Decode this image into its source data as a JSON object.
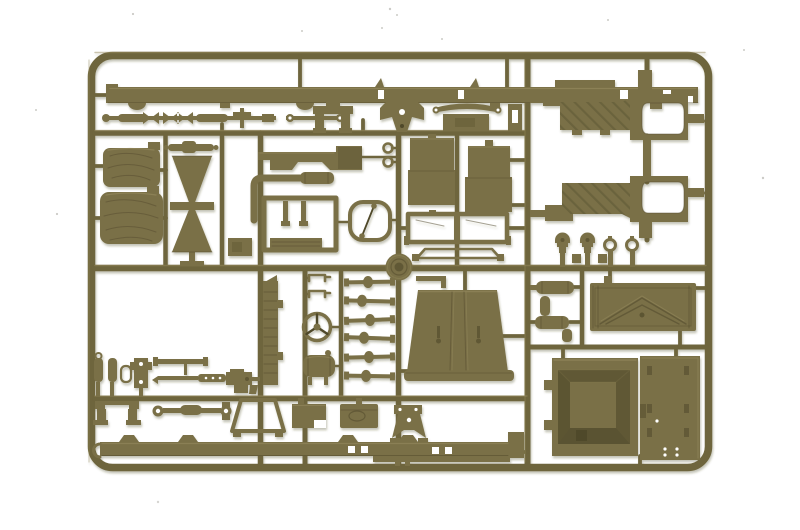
{
  "scene": {
    "description": "Photograph of an olive drab injection-molded plastic model kit sprue (parts tree) of military vehicle components on a white background",
    "background_color": "#ffffff",
    "colors": {
      "plastic_base": "#7a7047",
      "plastic_runner": "#6e653c",
      "plastic_dark": "#50482a",
      "plastic_light": "#978c60",
      "plastic_shadow": "#615936",
      "speck": "#cccbc7"
    },
    "sprue_frame": {
      "left_px": 88,
      "top_px": 52,
      "right_px": 712,
      "bottom_px": 470,
      "corner_radius_px": 21
    }
  },
  "parts": [
    {
      "name": "chassis-side-rail",
      "count": 2
    },
    {
      "name": "front-drive-shaft",
      "count": 1
    },
    {
      "name": "rear-drive-shaft",
      "count": 1
    },
    {
      "name": "transfer-case-bracket",
      "count": 2
    },
    {
      "name": "engine-mount-bracket",
      "count": 1
    },
    {
      "name": "leaf-spring-assembly",
      "count": 1
    },
    {
      "name": "leaf-spring-pack",
      "count": 1
    },
    {
      "name": "canvas-covered-cushion",
      "count": 2
    },
    {
      "name": "radiator-support-frame",
      "count": 1
    },
    {
      "name": "tie-rod",
      "count": 1
    },
    {
      "name": "exhaust-pipe",
      "count": 1
    },
    {
      "name": "body-side-sill",
      "count": 1
    },
    {
      "name": "seat-frame",
      "count": 1
    },
    {
      "name": "brake-line-loop",
      "count": 1
    },
    {
      "name": "towing-eyelet",
      "count": 2
    },
    {
      "name": "seat-back",
      "count": 2
    },
    {
      "name": "windshield-frame",
      "count": 1
    },
    {
      "name": "canvas-top-bow",
      "count": 1
    },
    {
      "name": "wheel-hub-disc",
      "count": 1
    },
    {
      "name": "front-fender",
      "count": 2
    },
    {
      "name": "headlight",
      "count": 2
    },
    {
      "name": "blackout-lamp",
      "count": 2
    },
    {
      "name": "muffler",
      "count": 2
    },
    {
      "name": "tailgate-panel",
      "count": 1
    },
    {
      "name": "firewall-cowl-box",
      "count": 1
    },
    {
      "name": "door-panel-with-handles",
      "count": 1
    },
    {
      "name": "engine-hood",
      "count": 1
    },
    {
      "name": "axle-shaft",
      "count": 6
    },
    {
      "name": "steering-wheel",
      "count": 1
    },
    {
      "name": "fuel-tank",
      "count": 1
    },
    {
      "name": "wiper-bracket",
      "count": 2
    },
    {
      "name": "spring-shackle",
      "count": 4
    },
    {
      "name": "machine-gun",
      "count": 1
    },
    {
      "name": "gun-cradle",
      "count": 1
    },
    {
      "name": "bumperette-bracket",
      "count": 1
    },
    {
      "name": "tow-bar-frame",
      "count": 1
    },
    {
      "name": "battery-box",
      "count": 1
    },
    {
      "name": "tool-box",
      "count": 1
    },
    {
      "name": "air-intake-elbow",
      "count": 1
    }
  ]
}
